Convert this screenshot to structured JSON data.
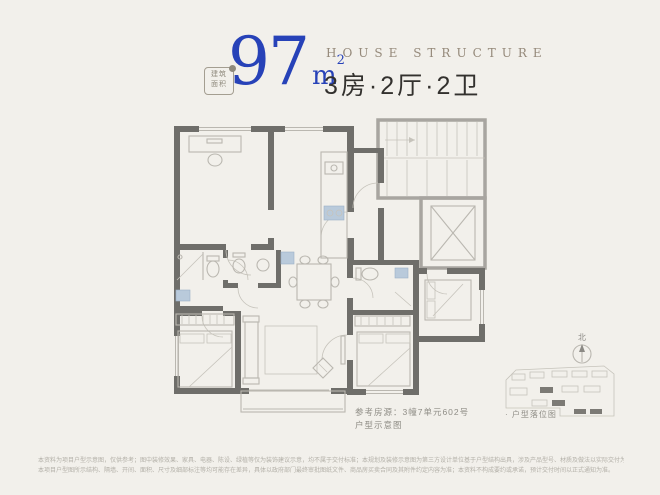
{
  "page": {
    "background": "#f2f0eb"
  },
  "header": {
    "badge": {
      "line1": "建筑",
      "line2": "面积"
    },
    "area": {
      "value": "97",
      "unit": "m",
      "sup": "2"
    },
    "title_en": "HOUSE STRUCTURE",
    "title_cn": "3房·2厅·2卫",
    "accent_color": "#2742b8"
  },
  "floor_plan": {
    "reference": {
      "line1": "参考房源：3幢7单元602号",
      "line2": "户型示意图"
    },
    "colors": {
      "wall": "#6f6e6a",
      "common_wall": "#a8a5a0",
      "line": "#bab7b0",
      "fixture_blue": "#b9cadb"
    }
  },
  "site_plan": {
    "north_label": "北",
    "caption": "· 户型落位图"
  },
  "disclaimer": {
    "line1": "本资料为项目户型示意图，仅供参考；图中装修效果、家具、电器、陈设、绿植等仅为装饰建议示意，均不属于交付标准；本规划及装修示意图为第三方设计单位基于户型结构出具，涉及产品型号、材质及做法以实际交付为准；",
    "line2": "本项目户型图所示结构、隔墙、开间、面积、尺寸及细部标注等均可能存在差异，具体以政府部门最终审批图纸文件、商品房买卖合同及其附件约定内容为准；本资料不构成要约或承诺，预计交付时间以正式通知为准。"
  }
}
